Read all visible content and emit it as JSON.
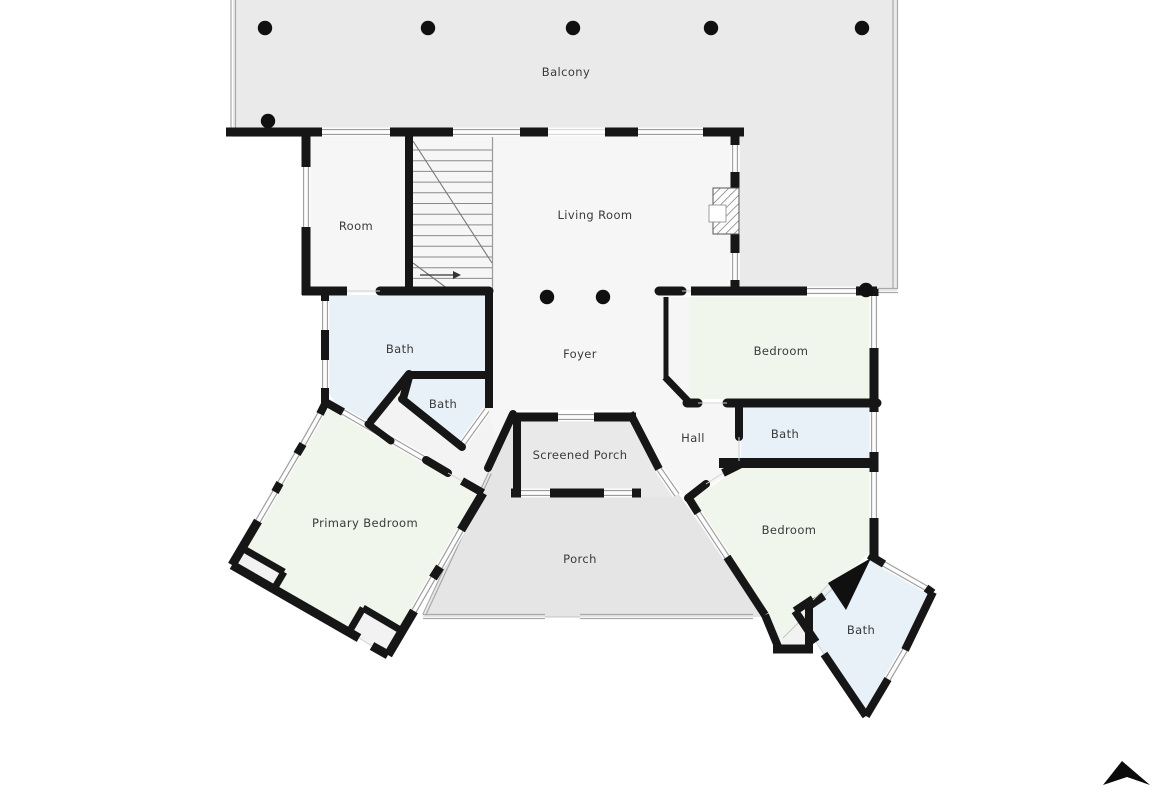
{
  "app": {
    "kind": "floor-plan-view",
    "background": "#ffffff"
  },
  "rooms": [
    {
      "id": "balcony",
      "label": "Balcony"
    },
    {
      "id": "room",
      "label": "Room"
    },
    {
      "id": "living-room",
      "label": "Living Room"
    },
    {
      "id": "bath-upper-left",
      "label": "Bath"
    },
    {
      "id": "bath-small-left",
      "label": "Bath"
    },
    {
      "id": "foyer",
      "label": "Foyer"
    },
    {
      "id": "bedroom-upper-right",
      "label": "Bedroom"
    },
    {
      "id": "bath-right",
      "label": "Bath"
    },
    {
      "id": "hall",
      "label": "Hall"
    },
    {
      "id": "screened-porch",
      "label": "Screened Porch"
    },
    {
      "id": "primary-bedroom",
      "label": "Primary Bedroom"
    },
    {
      "id": "porch",
      "label": "Porch"
    },
    {
      "id": "bedroom-lower-right",
      "label": "Bedroom"
    },
    {
      "id": "bath-lower-right",
      "label": "Bath"
    }
  ],
  "icons": {
    "north_arrow": "north-arrow-icon"
  },
  "colors": {
    "wall": "#161616",
    "floor": "#f6f6f6",
    "bath": "#e8f1f8",
    "bedroom": "#f1f6ec",
    "balcony": "#eaeaea",
    "porch": "#e5e5e5",
    "screened_porch": "#e9e9e9",
    "outside": "#ffffff",
    "label": "#3a3a3a",
    "window_line": "#9b9b9b"
  }
}
